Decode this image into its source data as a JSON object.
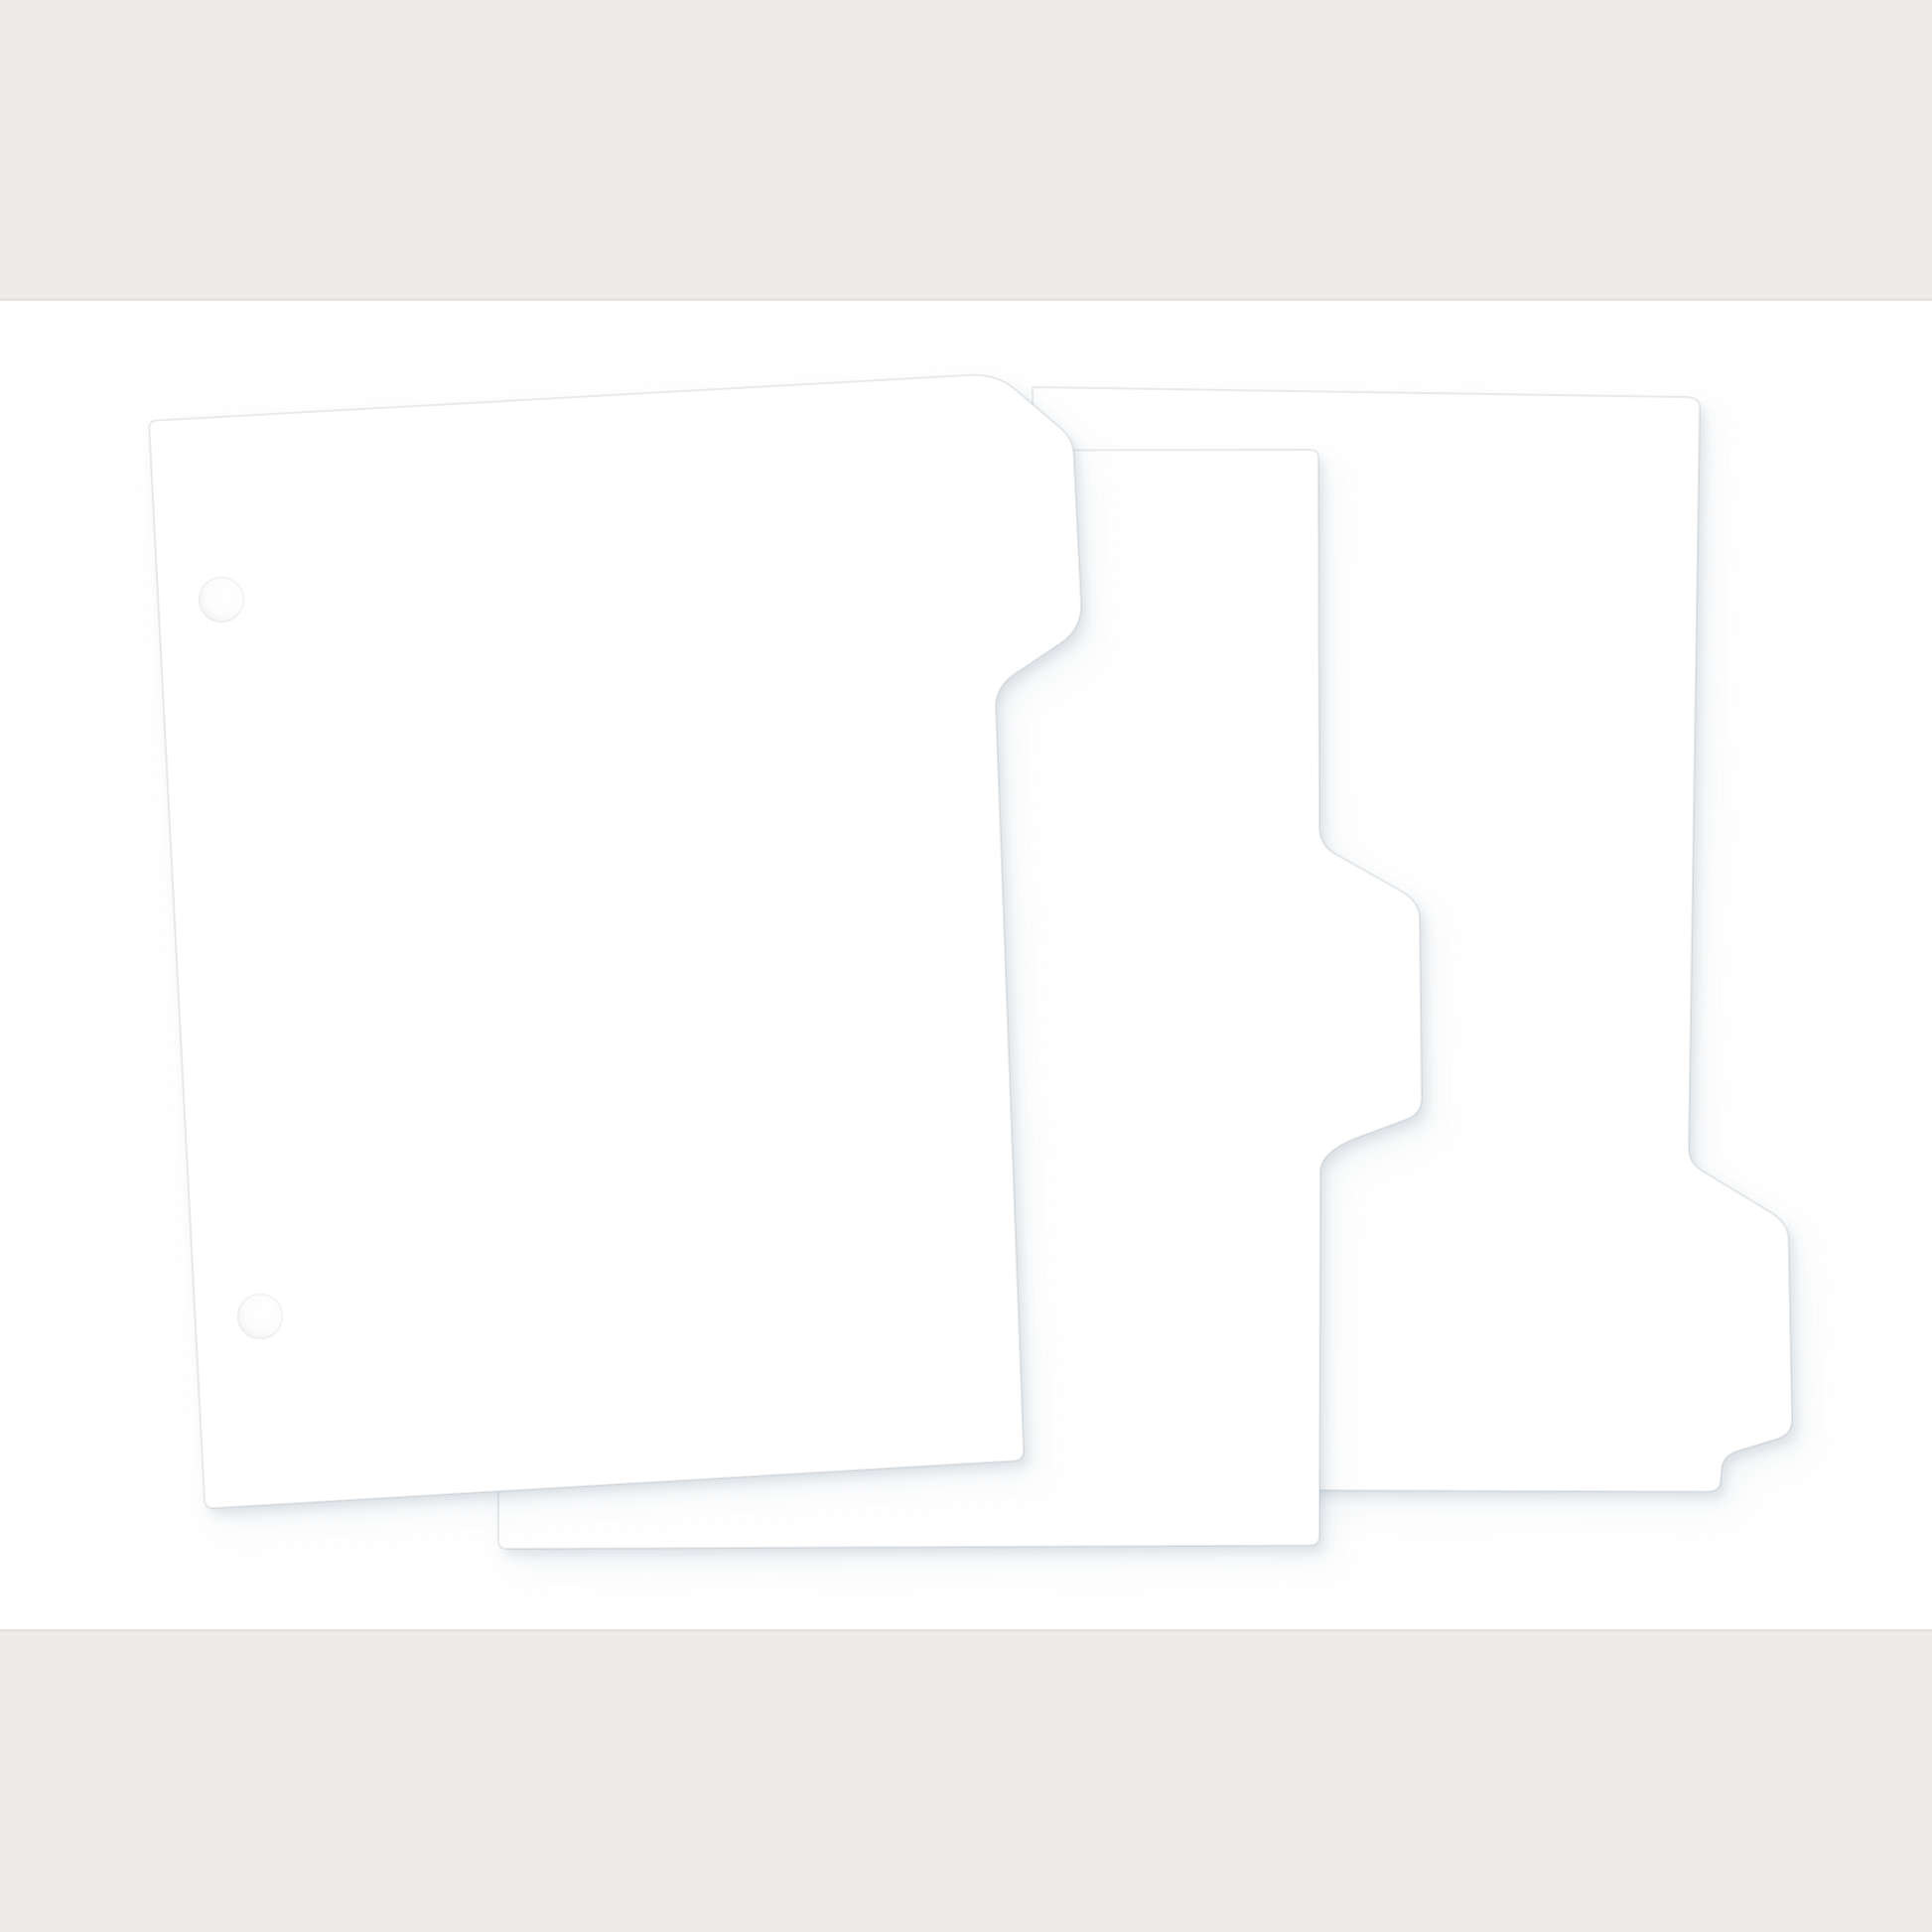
{
  "scene": {
    "description": "Product photo of three blank white index divider sheets with die-cut side tabs (top, middle and bottom tab positions) fanned out and overlapping on a white surface",
    "background": {
      "top_band_color": "#EDECE9",
      "bottom_band_color": "#EDECE9",
      "band_edge_color": "#E3E2DF",
      "surface_color": "#FFFFFF"
    },
    "shadow_color": "#8193A5",
    "sheets": [
      {
        "name": "divider-sheet-tab-top",
        "tab_position": "top of right edge",
        "fill": "#FFFFFF",
        "punch_holes": 2
      },
      {
        "name": "divider-sheet-tab-middle",
        "tab_position": "middle of right edge",
        "fill": "#FFFFFF",
        "punch_holes": 0
      },
      {
        "name": "divider-sheet-tab-bottom",
        "tab_position": "bottom of right edge",
        "fill": "#FFFFFF",
        "punch_holes": 0
      }
    ],
    "hole_rim_color": "#E6E7E8"
  }
}
